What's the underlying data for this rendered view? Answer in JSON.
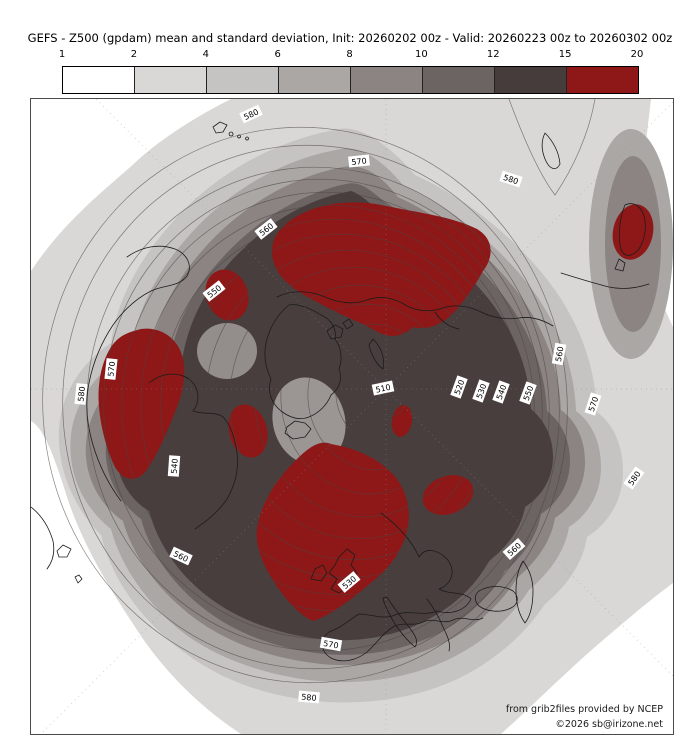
{
  "credits": {
    "line1": "from grib2files provided by NCEP",
    "line2": "©2026 sb@irizone.net"
  },
  "chart_data": {
    "type": "contour-map",
    "projection": "north-polar-stereographic",
    "title": "GEFS - Z500 (gpdam) mean and standard deviation, Init: 20260202 00z - Valid: 20260223 00z to 20260302 00z",
    "variable": "Z500 (gpdam)",
    "statistic": "mean and standard deviation",
    "init": "20260202 00z",
    "valid": "20260223 00z to 20260302 00z",
    "mean_contours": {
      "interval_gpdam": 5,
      "labeled_levels": [
        510,
        520,
        530,
        540,
        550,
        560,
        570,
        580
      ]
    },
    "stddev_shading": {
      "bin_edges": [
        "1",
        "2",
        "4",
        "6",
        "8",
        "10",
        "12",
        "15",
        "20"
      ],
      "bin_colors": [
        "#ffffff",
        "#d9d8d7",
        "#c6c4c3",
        "#aaa7a5",
        "#8b8482",
        "#6b6462",
        "#463c3b",
        "#8e1818"
      ]
    },
    "map": {
      "width": 642,
      "height": 635,
      "colors": {
        "red": "#8e1818",
        "coast": "#1c1c1c",
        "contour": "#4a4440",
        "graticule": "#909090",
        "label_bg": "#ffffff",
        "label_text": "#000000"
      },
      "bands": [
        {
          "level": "1-2",
          "color": "#ffffff",
          "d": "M 0,0 H 642 V 635 H 0 Z"
        },
        {
          "level": "2-4",
          "color": "#d9d8d7",
          "d": "M 200,0 C 160,20 128,42 108,60 C 78,88 36,118 0,172 L 0,322 C 14,330 24,360 38,404 C 55,452 80,492 112,540 C 140,580 175,612 210,635 L 470,635 C 498,610 532,576 564,548 C 592,524 620,500 642,484 L 642,228 C 626,194 613,158 611,118 C 609,78 616,38 620,0 Z"
        },
        {
          "level": "4-6",
          "color": "#c6c4c3",
          "d": "M 308,30 C 242,42 188,74 148,116 C 112,154 86,198 80,244 C 52,262 30,294 28,330 C 26,372 44,410 70,436 C 80,478 108,518 146,548 C 184,578 228,596 284,602 C 334,607 384,599 422,582 C 460,565 492,538 514,505 C 536,487 552,464 556,438 C 578,424 592,401 592,373 C 592,345 582,325 566,313 C 564,260 544,214 511,174 C 476,132 432,98 384,76 C 362,50 332,26 308,30 Z"
        },
        {
          "level": "6-8",
          "color": "#aaa7a5",
          "d": "M 310,50 C 252,60 202,90 164,130 C 130,166 106,208 100,252 C 70,268 44,300 40,336 C 36,374 52,408 80,430 C 90,468 116,504 150,532 C 186,560 234,576 286,582 C 332,586 376,579 412,563 C 448,547 478,522 498,491 C 518,474 534,453 538,428 C 558,415 570,394 570,368 C 570,342 560,323 545,312 C 543,262 524,218 493,180 C 460,140 418,108 372,86 C 352,62 330,46 310,50 Z"
        },
        {
          "level": "8-10",
          "color": "#8b8482",
          "d": "M 312,68 C 260,78 214,106 178,144 C 146,178 124,218 118,260 C 88,274 62,302 56,336 C 50,372 66,404 92,422 C 102,458 128,492 162,518 C 196,544 242,560 290,565 C 332,569 372,562 406,547 C 440,532 468,508 486,479 C 505,463 520,443 524,419 C 542,407 554,387 554,363 C 554,339 544,321 530,311 C 528,264 510,222 481,186 C 450,148 410,118 367,98 C 350,76 332,64 312,68 Z"
        },
        {
          "level": "10-12",
          "color": "#6b6462",
          "d": "M 315,85 C 268,95 225,122 192,158 C 162,190 142,228 138,268 C 108,280 82,306 76,338 C 70,372 86,402 110,420 C 120,456 144,488 176,512 C 208,536 250,551 294,555 C 332,558 368,552 400,538 C 432,523 458,500 474,472 C 492,457 506,438 510,415 C 527,404 539,385 539,362 C 539,339 529,322 516,312 C 514,268 497,228 470,194 C 441,158 403,128 362,108 C 347,100 333,80 315,85 Z"
        },
        {
          "level": "12-15",
          "color": "#483e3d",
          "d": "M 320,92 C 275,100 235,125 202,160 C 172,192 154,230 150,270 C 118,278 92,302 86,334 C 80,368 94,398 118,412 C 128,448 150,478 180,500 C 210,522 250,536 290,540 C 325,544 360,538 390,524 C 420,510 444,488 458,462 C 476,448 490,430 494,408 C 510,398 522,380 522,358 C 522,336 512,320 500,310 C 498,268 482,230 456,198 C 428,164 392,136 354,116 C 342,108 332,96 320,92 Z"
        }
      ],
      "extra_patches": [
        {
          "name": "right-edge-lobe-outer",
          "color": "#aaa7a5",
          "e": [
            600,
            145,
            42,
            115,
            0
          ]
        },
        {
          "name": "right-edge-lobe-inner",
          "color": "#8b8482",
          "e": [
            602,
            145,
            28,
            88,
            0
          ]
        },
        {
          "name": "light-patch-baffin",
          "color": "#938e8c",
          "e": [
            196,
            252,
            30,
            28,
            0
          ]
        },
        {
          "name": "light-patch-greenland",
          "color": "#9b9694",
          "e": [
            278,
            322,
            36,
            44,
            -15
          ]
        },
        {
          "name": "light-patch-siberia",
          "color": "#a5a19f",
          "e": [
            403,
            180,
            22,
            16,
            -10
          ]
        }
      ],
      "red_blobs": [
        {
          "name": "north-pacific-siberia",
          "d": "M 255,125 C 280,104 320,99 355,107 C 390,114 422,118 446,130 C 463,140 463,158 452,172 C 445,185 436,198 426,210 C 413,225 398,232 382,228 C 372,238 358,240 345,232 C 325,221 305,214 288,204 C 270,195 251,184 244,167 C 237,150 242,136 255,125 Z"
        },
        {
          "name": "aleutian-spot",
          "e": [
            196,
            196,
            21,
            26,
            -20
          ]
        },
        {
          "name": "ne-north-america",
          "d": "M 110,230 C 130,227 148,240 152,260 C 156,280 150,300 142,318 C 134,338 125,358 115,372 C 105,384 92,382 84,368 C 76,352 70,330 68,308 C 66,286 70,264 80,248 C 88,236 98,233 110,230 Z"
        },
        {
          "name": "iceland-spot",
          "e": [
            217,
            332,
            19,
            27,
            -15
          ]
        },
        {
          "name": "barents-spot",
          "e": [
            371,
            322,
            10,
            16,
            10
          ]
        },
        {
          "name": "uk-western-europe",
          "d": "M 300,345 C 330,350 360,365 372,390 C 382,412 378,435 368,452 C 360,468 345,480 330,492 C 315,505 295,518 282,522 C 268,516 252,498 240,478 C 228,458 222,440 228,420 C 234,398 248,378 264,362 C 276,350 288,340 300,345 Z"
        },
        {
          "name": "west-siberia-spot",
          "e": [
            417,
            396,
            26,
            19,
            -20
          ]
        },
        {
          "name": "japan-spot",
          "e": [
            602,
            133,
            20,
            28,
            12
          ]
        }
      ],
      "graticule": [
        [
          0,
          290,
          642,
          290
        ],
        [
          355,
          0,
          355,
          635
        ],
        [
          65,
          0,
          642,
          577
        ],
        [
          642,
          3,
          10,
          635
        ]
      ],
      "contour_rings": [
        [
          355,
          292,
          22,
          26
        ],
        [
          349,
          295,
          44,
          50
        ],
        [
          343,
          298,
          66,
          73
        ],
        [
          337,
          300,
          87,
          95
        ],
        [
          331,
          302,
          107,
          116
        ],
        [
          325,
          304,
          126,
          136
        ],
        [
          319,
          306,
          144,
          155
        ],
        [
          313,
          307,
          161,
          172
        ],
        [
          307,
          308,
          177,
          188
        ],
        [
          302,
          309,
          192,
          203
        ],
        [
          297,
          310,
          206,
          217
        ],
        [
          292,
          310,
          219,
          230
        ],
        [
          287,
          310,
          231,
          242
        ],
        [
          280,
          308,
          248,
          262
        ],
        [
          274,
          306,
          262,
          278
        ]
      ],
      "extra_contours": [
        "M 478,0 C 492,38 508,75 524,96 C 543,68 558,34 564,0"
      ],
      "contour_labels": [
        {
          "t": "580",
          "x": 220,
          "y": 15,
          "r": -25
        },
        {
          "t": "570",
          "x": 328,
          "y": 62,
          "r": -6
        },
        {
          "t": "580",
          "x": 480,
          "y": 80,
          "r": 18
        },
        {
          "t": "560",
          "x": 235,
          "y": 130,
          "r": -38
        },
        {
          "t": "550",
          "x": 183,
          "y": 192,
          "r": -38
        },
        {
          "t": "510",
          "x": 352,
          "y": 289,
          "r": -12
        },
        {
          "t": "520",
          "x": 428,
          "y": 288,
          "r": -70
        },
        {
          "t": "530",
          "x": 450,
          "y": 292,
          "r": -70
        },
        {
          "t": "540",
          "x": 470,
          "y": 293,
          "r": -70
        },
        {
          "t": "550",
          "x": 497,
          "y": 294,
          "r": -70
        },
        {
          "t": "560",
          "x": 528,
          "y": 255,
          "r": -80
        },
        {
          "t": "570",
          "x": 562,
          "y": 305,
          "r": -72
        },
        {
          "t": "580",
          "x": 603,
          "y": 379,
          "r": -55
        },
        {
          "t": "570",
          "x": 80,
          "y": 270,
          "r": -84
        },
        {
          "t": "580",
          "x": 50,
          "y": 295,
          "r": -84
        },
        {
          "t": "540",
          "x": 143,
          "y": 367,
          "r": -86
        },
        {
          "t": "560",
          "x": 150,
          "y": 457,
          "r": 25
        },
        {
          "t": "530",
          "x": 318,
          "y": 483,
          "r": -40
        },
        {
          "t": "560",
          "x": 483,
          "y": 450,
          "r": -42
        },
        {
          "t": "570",
          "x": 300,
          "y": 545,
          "r": 10
        },
        {
          "t": "580",
          "x": 278,
          "y": 598,
          "r": 5
        }
      ],
      "coastlines": [
        "M 96,158 C 110,148 128,144 144,150 C 156,155 162,166 156,177 C 148,188 132,186 120,192 C 104,200 92,212 82,226 C 70,244 62,264 58,284 C 54,304 56,326 62,346 C 68,366 78,386 90,402",
        "M 118,284 C 130,274 146,272 158,280 C 168,288 170,302 162,312 C 172,316 184,312 192,318 C 200,326 204,340 206,354 C 208,370 204,386 196,400 C 188,412 176,422 164,430",
        "M 0,408 C 10,416 18,428 22,442 C 24,452 22,462 16,470",
        "M 26,452 l 6,-6 8,4 -4,8 -8,0 z",
        "M 44,478 l 4,-2 3,4 -4,4 z",
        "M 258,206 C 248,214 240,226 236,240 C 232,254 234,268 240,280 C 236,292 240,304 250,312 C 258,318 268,322 278,318 C 288,314 296,306 300,296 C 308,290 312,280 308,270 C 312,260 310,248 304,240 C 306,230 300,220 290,216 C 280,210 268,204 258,206 Z",
        "M 256,328 L 264,322 274,324 280,330 274,338 262,340 254,334 Z",
        "M 296,232 l 8,-6 8,4 -2,8 -10,2 z",
        "M 312,224 l 6,-4 4,6 -6,4 z",
        "M 342,240 C 350,248 354,258 352,270 C 346,266 340,256 338,246 Z",
        "M 308,458 L 316,450 324,456 320,466 326,474 318,486 308,494 300,490 306,480 298,474 304,466 Z",
        "M 284,470 L 292,466 296,474 290,482 280,480 Z",
        "M 350,414 C 366,426 380,440 388,458 C 394,448 406,450 416,460 C 426,472 420,486 408,490 C 418,496 432,492 440,500 C 434,512 420,516 406,512 C 392,518 378,510 364,516 C 352,521 340,515 328,515 C 318,521 310,529 298,533 C 288,541 290,553 300,559 C 312,565 326,561 336,553 C 346,544 352,534 362,528 C 372,522 382,528 392,523 C 402,518 412,526 422,521 C 432,516 442,524 452,519",
        "M 356,498 C 362,508 370,518 378,528 C 384,536 388,542 384,548 C 378,543 370,534 364,525 C 358,515 353,505 352,499 Z",
        "M 396,500 C 402,508 408,518 412,528 C 416,536 420,544 418,552",
        "M 448,492 C 458,486 472,486 482,492 C 488,497 488,505 480,509 C 470,514 456,513 448,507 C 443,502 443,496 448,492 Z",
        "M 492,462 C 498,470 502,480 502,492 C 502,504 500,516 494,524 C 488,516 485,504 485,492 C 485,480 487,470 492,462 Z",
        "M 246,198 C 262,190 280,192 294,198 C 308,204 322,206 336,201 C 350,196 364,199 376,207 C 388,213 400,213 412,209 C 424,205 438,207 450,213 C 462,219 476,221 488,219 C 500,217 512,221 522,227",
        "M 404,213 C 410,222 418,228 428,230",
        "M 514,34 C 522,42 528,53 529,65 C 525,73 518,70 514,60 C 510,50 510,42 514,34 Z",
        "M 530,174 C 546,179 562,184 578,188 C 592,191 606,189 618,185",
        "M 594,106 C 602,102 610,107 613,117 C 616,128 614,140 608,150 C 601,158 593,159 590,150 C 587,138 588,120 594,106 Z",
        "M 588,160 l 6,4 -2,8 -8,-2 z",
        "M 182,28 l 7,-5 7,3 -4,7 -7,1 z",
        "M 200,33 a 2,2 0 1 0 0.1,0 z",
        "M 208,36 a 1.5,1.5 0 1 0 0.1,0 z",
        "M 216,38 a 1.5,1.5 0 1 0 0.1,0 z"
      ]
    }
  }
}
